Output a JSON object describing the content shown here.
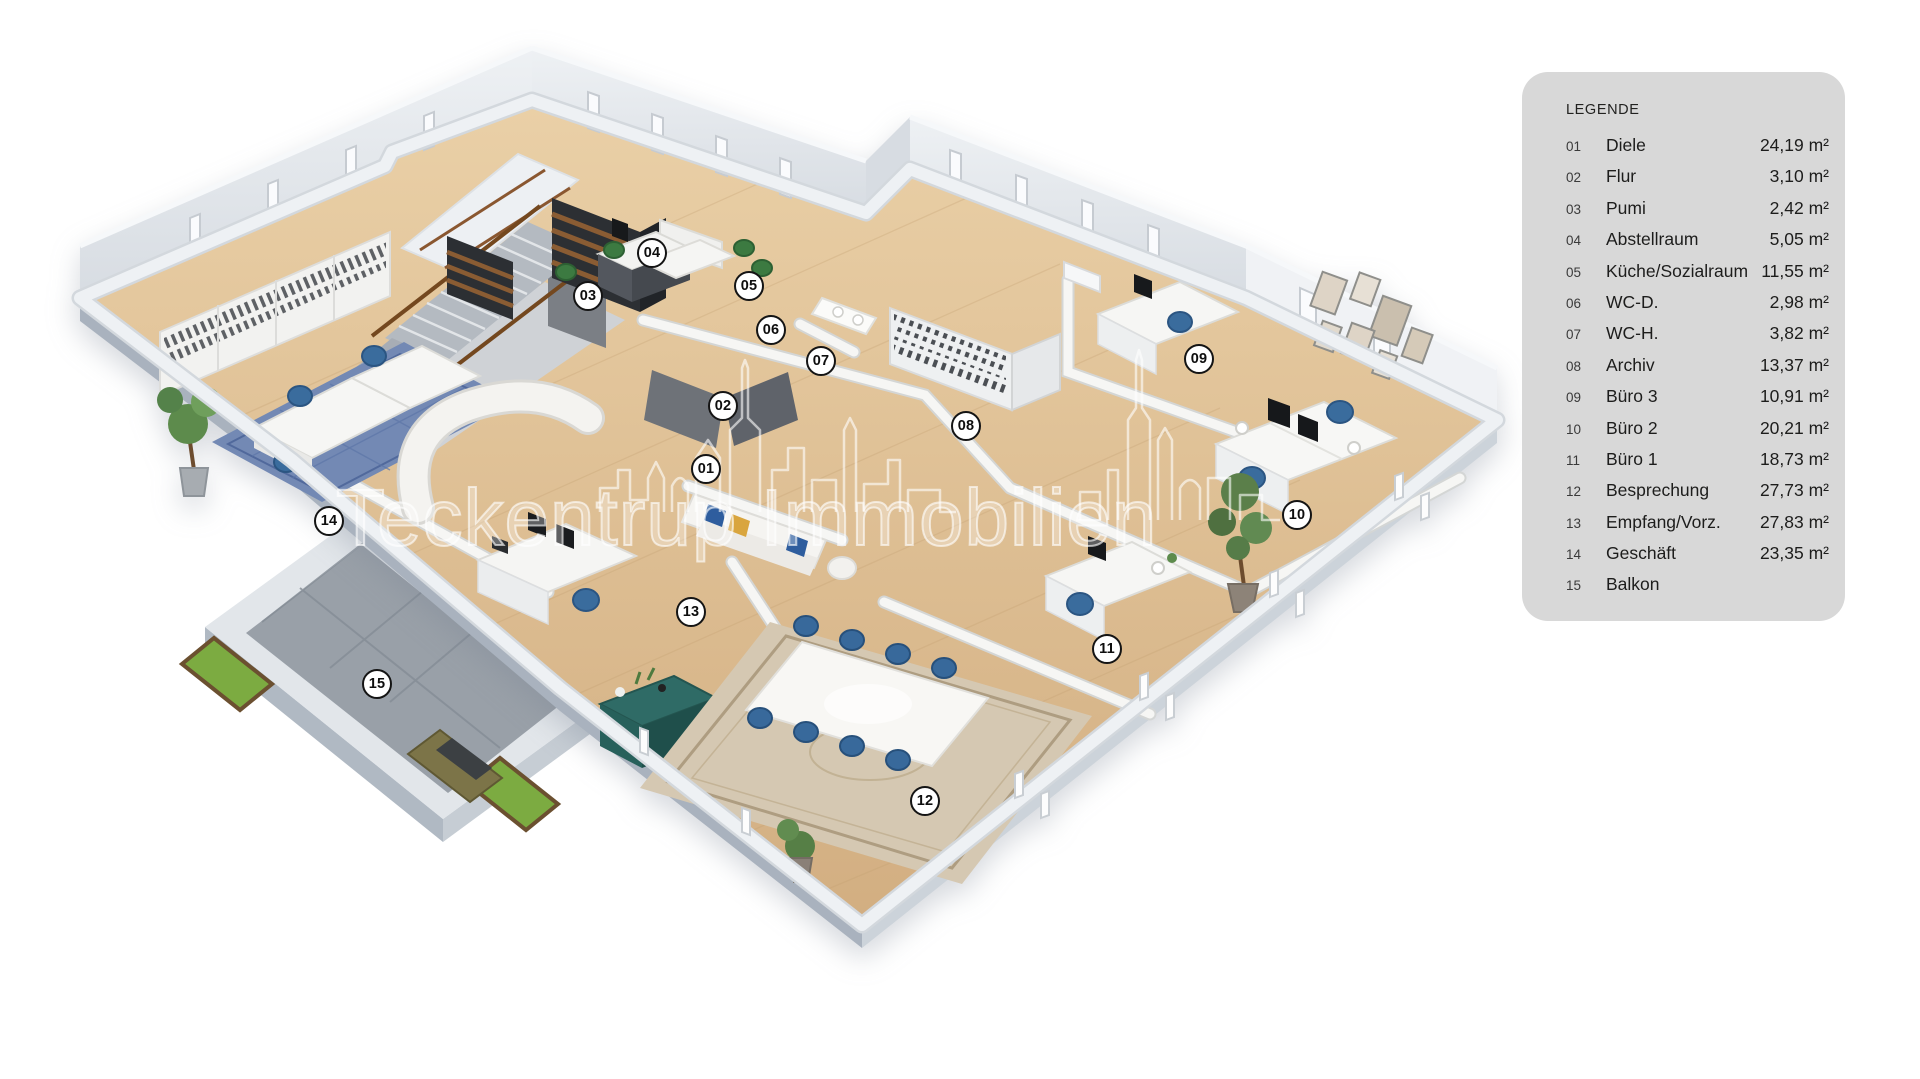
{
  "legend": {
    "title": "LEGENDE",
    "rows": [
      {
        "num": "01",
        "name": "Diele",
        "area": "24,19 m²"
      },
      {
        "num": "02",
        "name": "Flur",
        "area": "3,10 m²"
      },
      {
        "num": "03",
        "name": "Pumi",
        "area": "2,42 m²"
      },
      {
        "num": "04",
        "name": "Abstellraum",
        "area": "5,05 m²"
      },
      {
        "num": "05",
        "name": "Küche/Sozialraum",
        "area": "11,55 m²"
      },
      {
        "num": "06",
        "name": "WC-D.",
        "area": "2,98 m²"
      },
      {
        "num": "07",
        "name": "WC-H.",
        "area": "3,82 m²"
      },
      {
        "num": "08",
        "name": "Archiv",
        "area": "13,37 m²"
      },
      {
        "num": "09",
        "name": "Büro 3",
        "area": "10,91 m²"
      },
      {
        "num": "10",
        "name": "Büro 2",
        "area": "20,21 m²"
      },
      {
        "num": "11",
        "name": "Büro 1",
        "area": "18,73 m²"
      },
      {
        "num": "12",
        "name": "Besprechung",
        "area": "27,73 m²"
      },
      {
        "num": "13",
        "name": "Empfang/Vorz.",
        "area": "27,83 m²"
      },
      {
        "num": "14",
        "name": "Geschäft",
        "area": "23,35 m²"
      },
      {
        "num": "15",
        "name": "Balkon",
        "area": ""
      }
    ]
  },
  "watermark": {
    "text": "Teckentrup Immobilien"
  },
  "markers": [
    {
      "label": "01",
      "x": 706,
      "y": 469
    },
    {
      "label": "02",
      "x": 723,
      "y": 406
    },
    {
      "label": "03",
      "x": 588,
      "y": 296
    },
    {
      "label": "04",
      "x": 652,
      "y": 253
    },
    {
      "label": "05",
      "x": 749,
      "y": 286
    },
    {
      "label": "06",
      "x": 771,
      "y": 330
    },
    {
      "label": "07",
      "x": 821,
      "y": 361
    },
    {
      "label": "08",
      "x": 966,
      "y": 426
    },
    {
      "label": "09",
      "x": 1199,
      "y": 359
    },
    {
      "label": "10",
      "x": 1297,
      "y": 515
    },
    {
      "label": "11",
      "x": 1107,
      "y": 649
    },
    {
      "label": "12",
      "x": 925,
      "y": 801
    },
    {
      "label": "13",
      "x": 691,
      "y": 612
    },
    {
      "label": "14",
      "x": 329,
      "y": 521
    },
    {
      "label": "15",
      "x": 377,
      "y": 684
    }
  ],
  "colors": {
    "legend_bg": "#d8d8d8",
    "marker_border": "#141414",
    "floor_wood": "#dcbb90",
    "wall_white": "#f4f4f2",
    "slab_gray": "#c3cbd4",
    "accent_blue": "#38699b",
    "accent_teal": "#2e6b66",
    "accent_green": "#3d7a41",
    "balcony_tile": "#99a0a8"
  }
}
